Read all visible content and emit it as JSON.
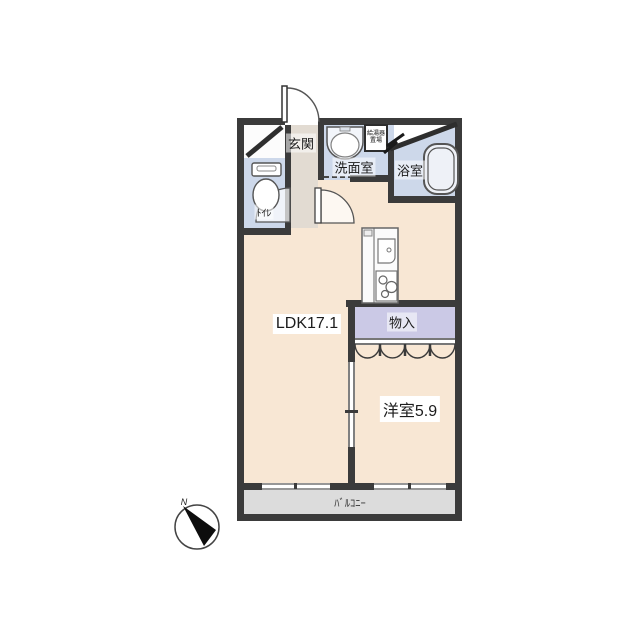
{
  "meta": {
    "type": "floorplan",
    "background": "#ffffff"
  },
  "colors": {
    "wall": "#3b3b3b",
    "room_beige": "#f8e7d4",
    "wet_area_blue": "#cdd8ea",
    "storage_lavender": "#cbc9e6",
    "entrance_gray": "#e2dbd2",
    "balcony_gray": "#dcdcdc"
  },
  "rooms": {
    "entrance": {
      "label": "玄関"
    },
    "washroom": {
      "label": "洗面室"
    },
    "bathroom": {
      "label": "浴室"
    },
    "toilet": {
      "label": "ﾄｲﾚ"
    },
    "water_heater": {
      "label": "給湯器置場"
    },
    "ldk": {
      "label": "LDK17.1",
      "size_jo": 17.1
    },
    "storage": {
      "label": "物入"
    },
    "western_room": {
      "label": "洋室5.9",
      "size_jo": 5.9
    },
    "balcony": {
      "label": "ﾊﾞﾙｺﾆｰ"
    }
  },
  "compass": {
    "north_label": "N"
  }
}
